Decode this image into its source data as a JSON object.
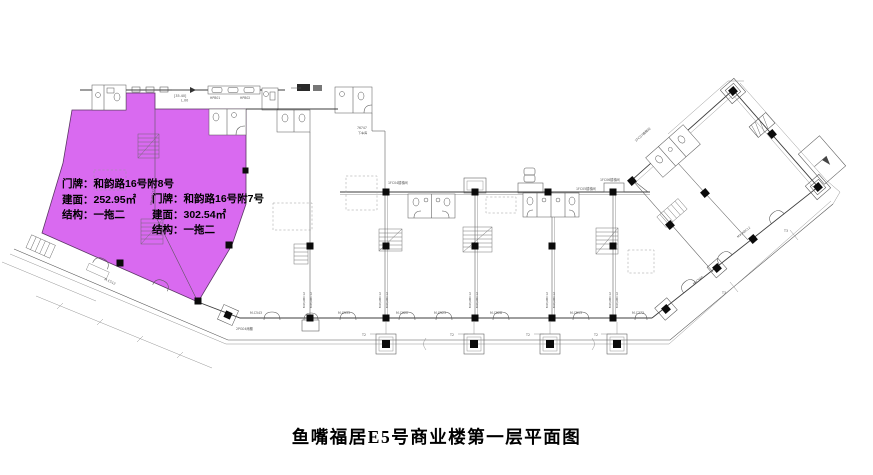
{
  "document": {
    "title": "鱼嘴福居E5号商业楼第一层平面图"
  },
  "highlight": {
    "fill_color": "#d96af0",
    "units": [
      {
        "name": "unit-fu8",
        "fields": [
          {
            "label": "门牌：",
            "value": "和韵路16号附8号"
          },
          {
            "label": "建面：",
            "value": "252.95㎡"
          },
          {
            "label": "结构：",
            "value": "一拖二"
          }
        ]
      },
      {
        "name": "unit-fu7",
        "fields": [
          {
            "label": "门牌：",
            "value": "和韵路16号附7号"
          },
          {
            "label": "建面：",
            "value": "302.54㎡"
          },
          {
            "label": "结构：",
            "value": "一拖二"
          }
        ]
      }
    ]
  },
  "plan_annotations": {
    "elevation": "[35.40]",
    "level": "L.00",
    "fixture_codes": [
      "HPB01",
      "HPB02"
    ],
    "ramp_note_1": "76747",
    "ramp_note_2": "下车库",
    "stair_labels": [
      "1FC04楼梯间",
      "1FC05楼梯间",
      "1FC06楼梯间",
      "1FC07楼梯间"
    ],
    "door_codes": {
      "mc543": "M.C543",
      "mc533": "M.C533",
      "mc020": "M.C020",
      "mc523": "M.C523",
      "mc528": "M.C528",
      "mc513": "M.C513",
      "mc373": "M.C373",
      "mc540": "M.C540",
      "mc512": "M.C512"
    },
    "wall_tag": "M#/ABC12",
    "joint_t2": "T2",
    "joint_t3": "T3",
    "canopy_note": "2PG04雨棚"
  }
}
